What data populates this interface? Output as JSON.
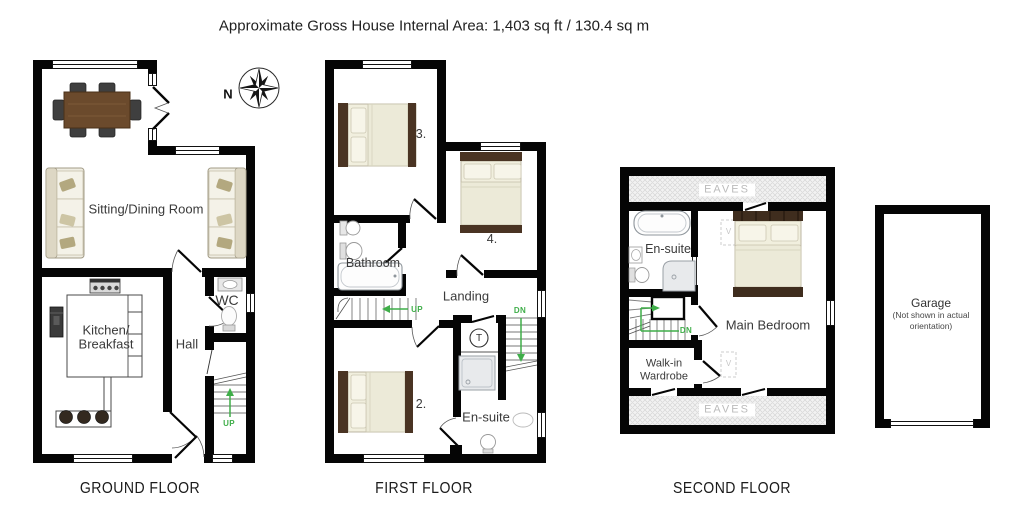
{
  "title": "Approximate Gross House Internal Area: 1,403 sq ft / 130.4 sq m",
  "compass": {
    "north": "N"
  },
  "ground_floor": {
    "label": "GROUND FLOOR",
    "rooms": {
      "sitting_dining": "Sitting/Dining Room",
      "kitchen_line1": "Kitchen/",
      "kitchen_line2": "Breakfast",
      "hall": "Hall",
      "wc": "WC"
    },
    "stairs": {
      "up": "UP"
    }
  },
  "first_floor": {
    "label": "FIRST FLOOR",
    "rooms": {
      "bedroom_3": "3.",
      "bedroom_4": "4.",
      "bathroom": "Bathroom",
      "landing": "Landing",
      "bedroom_2": "2.",
      "en_suite": "En-suite"
    },
    "tank": "T",
    "stairs": {
      "up": "UP",
      "down": "DN"
    }
  },
  "second_floor": {
    "label": "SECOND FLOOR",
    "rooms": {
      "en_suite": "En-suite",
      "main_bedroom": "Main Bedroom",
      "walk_in_line1": "Walk-in",
      "walk_in_line2": "Wardrobe"
    },
    "eaves_top": "EAVES",
    "eaves_bottom": "EAVES",
    "velux_1": "V",
    "velux_2": "V",
    "stairs": {
      "down": "DN"
    }
  },
  "garage": {
    "label": "Garage",
    "note_line1": "(Not shown in actual",
    "note_line2": "orientation)"
  },
  "colors": {
    "wall": "#050505",
    "stairs_arrow_green": "#3fae49",
    "wood_table": "#6b4a2c",
    "bed_frame": "#4a3423",
    "bed_linen": "#f1efde",
    "eaves_text": "#bcbcbc"
  }
}
